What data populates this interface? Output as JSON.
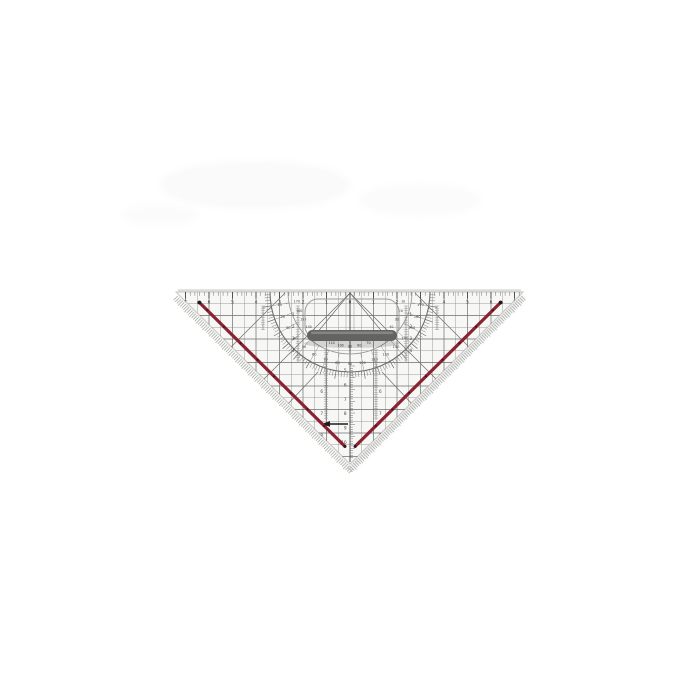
{
  "image": {
    "object": "transparent geometry set-square (protractor triangle) with handle, photographed on white background"
  },
  "colors": {
    "background": "#ffffff",
    "body_fill": "#f7f7f6",
    "body_edge": "#c6c6c4",
    "bevel_light": "#dcdcda",
    "line_dark": "#3f3f3f",
    "line_mid": "#6e6e6e",
    "line_light": "#929292",
    "hatch_gray": "#a9ada6",
    "hatch_tint": "#b9c0b4",
    "ink_edge_red": "#8a2433",
    "ink_edge_dot": "#3a0e16",
    "end_dot_black": "#1c1c1c",
    "handle_gray": "#636363",
    "handle_highlight": "#8d8d8d",
    "handle_outline": "#9b9b9b",
    "number_gray": "#474747",
    "shadow_gray": "#cccccc",
    "smudge": "#9a9a9a"
  },
  "top_ruler": {
    "numbers": [
      "7",
      "6",
      "5",
      "4",
      "3",
      "2",
      "1",
      "0",
      "1",
      "2",
      "3",
      "4",
      "5",
      "6",
      "7"
    ]
  },
  "protractor": {
    "outer_degrees": [
      "10",
      "20",
      "30",
      "40",
      "50",
      "60",
      "70",
      "80",
      "90",
      "100",
      "110",
      "120",
      "130",
      "140",
      "150",
      "160",
      "170"
    ],
    "inner_degrees": [
      "170",
      "160",
      "150",
      "140",
      "130",
      "120",
      "110",
      "100",
      "90",
      "80",
      "70",
      "60",
      "50",
      "40",
      "30",
      "20",
      "10"
    ]
  },
  "scales": {
    "center_column": [
      "5",
      "6",
      "7",
      "8",
      "9",
      "10"
    ],
    "left_flank_column": [
      "6",
      "7",
      "8"
    ],
    "right_flank_column": [
      "6",
      "7",
      "8"
    ],
    "left_upper_column": [
      "1",
      "2",
      "3",
      "4"
    ],
    "right_upper_column": [
      "1",
      "2",
      "3",
      "4"
    ]
  }
}
